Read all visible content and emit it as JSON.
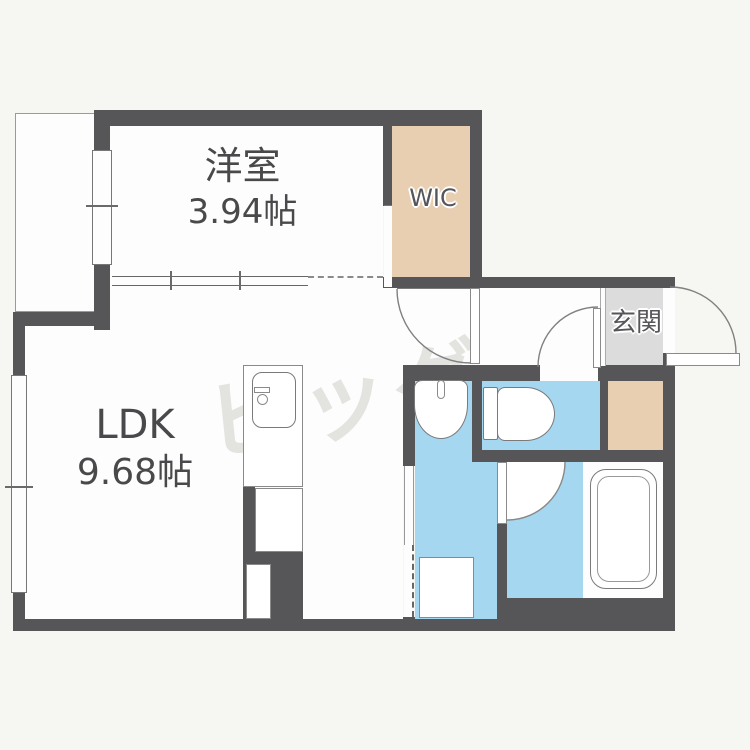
{
  "plan": {
    "title": "1LDK apartment floor plan",
    "rooms": {
      "western": {
        "name": "洋室",
        "area": "3.94帖"
      },
      "ldk": {
        "name": "LDK",
        "area": "9.68帖"
      },
      "wic": {
        "name": "WIC"
      },
      "entrance": {
        "name": "玄関"
      }
    },
    "watermark": "ビッグ",
    "colors": {
      "wall": "#565659",
      "room_floor": "#fdfdfd",
      "closet_floor": "#e8cfb2",
      "wet_area_floor": "#a6d7f0",
      "entrance_tile": "#dcdcdc",
      "background": "#f6f6f3"
    }
  }
}
